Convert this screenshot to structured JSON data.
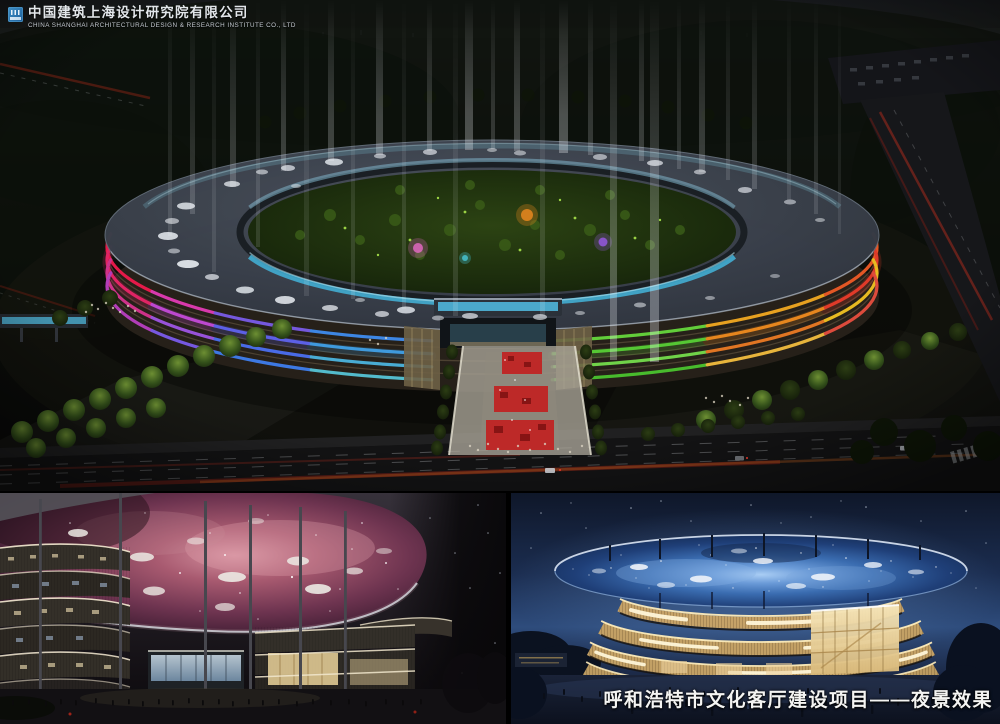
{
  "header": {
    "company_name_zh": "中国建筑上海设计研究院有限公司",
    "company_name_en": "CHINA SHANGHAI ARCHITECTURAL DESIGN & RESEARCH INSTITUTE CO., LTD"
  },
  "caption": "呼和浩特市文化客厅建设项目——夜景效果",
  "palette": {
    "logo_blue": "#2f7fba",
    "night_sky": "#0b0d09",
    "roof_gray": "#3a414c",
    "glass_teal": "#49b6da",
    "band_crimson": "#ef1a4c",
    "band_magenta": "#e23bb4",
    "band_purple": "#7b5ceb",
    "band_blue": "#3f8cee",
    "band_green": "#5cd335",
    "band_orange": "#ef8b1f",
    "nebula_pink": "#a85a70",
    "canopy_blue": "#3a6cb0",
    "facade_gold": "#c5a268"
  }
}
